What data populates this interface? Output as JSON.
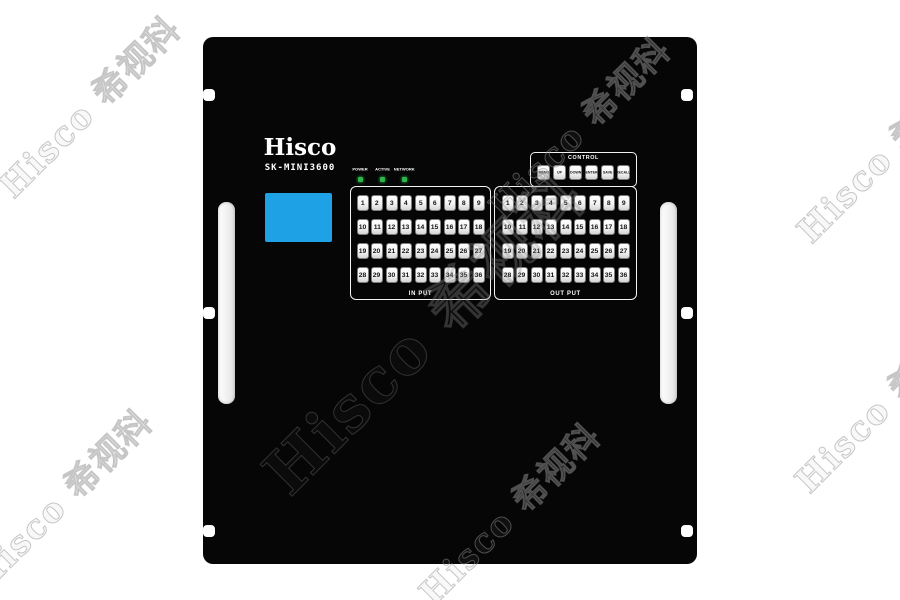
{
  "watermark": {
    "text": "Hisco 希视科"
  },
  "device": {
    "brand": "Hisco",
    "model": "SK-MINI3600",
    "screen": {
      "color": "#1fa1e6"
    },
    "status_leds": {
      "color": "#2fb449",
      "items": [
        {
          "label": "POWER"
        },
        {
          "label": "ACTIVE"
        },
        {
          "label": "NETWORK"
        }
      ]
    },
    "control": {
      "title": "CONTROL",
      "buttons": [
        {
          "label": "MENU"
        },
        {
          "label": "UP"
        },
        {
          "label": "DOWN"
        },
        {
          "label": "ENTER"
        },
        {
          "label": "SAVE"
        },
        {
          "label": "RECALL"
        }
      ]
    },
    "input_section": {
      "label": "IN PUT",
      "keys": [
        "1",
        "2",
        "3",
        "4",
        "5",
        "6",
        "7",
        "8",
        "9",
        "10",
        "11",
        "12",
        "13",
        "14",
        "15",
        "16",
        "17",
        "18",
        "19",
        "20",
        "21",
        "22",
        "23",
        "24",
        "25",
        "26",
        "27",
        "28",
        "29",
        "30",
        "31",
        "32",
        "33",
        "34",
        "35",
        "36"
      ]
    },
    "output_section": {
      "label": "OUT PUT",
      "keys": [
        "1",
        "2",
        "3",
        "4",
        "5",
        "6",
        "7",
        "8",
        "9",
        "10",
        "11",
        "12",
        "13",
        "14",
        "15",
        "16",
        "17",
        "18",
        "19",
        "20",
        "21",
        "22",
        "23",
        "24",
        "25",
        "26",
        "27",
        "28",
        "29",
        "30",
        "31",
        "32",
        "33",
        "34",
        "35",
        "36"
      ]
    }
  }
}
